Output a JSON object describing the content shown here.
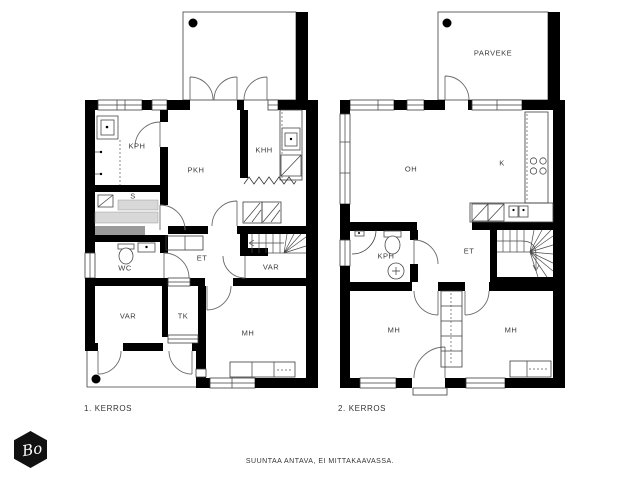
{
  "colors": {
    "wall": "#000000",
    "background": "#ffffff",
    "text": "#3a3a3a",
    "sauna_bench": "#d8d8d8",
    "sauna_bench_dark": "#9a9a9a",
    "logo_background": "#111111",
    "logo_text_color": "#ffffff"
  },
  "floor1": {
    "caption": "1. KERROS",
    "rooms": [
      {
        "label": "KPH"
      },
      {
        "label": "PKH"
      },
      {
        "label": "KHH"
      },
      {
        "label": "S"
      },
      {
        "label": "WC"
      },
      {
        "label": "ET"
      },
      {
        "label": "VAR"
      },
      {
        "label": "VAR"
      },
      {
        "label": "TK"
      },
      {
        "label": "MH"
      }
    ]
  },
  "floor2": {
    "caption": "2. KERROS",
    "rooms": [
      {
        "label": "PARVEKE"
      },
      {
        "label": "OH"
      },
      {
        "label": "K"
      },
      {
        "label": "KPH"
      },
      {
        "label": "ET"
      },
      {
        "label": "MH"
      },
      {
        "label": "MH"
      }
    ]
  },
  "footer": {
    "disclaimer": "SUUNTAA ANTAVA, EI MITTAKAAVASSA."
  },
  "logo": {
    "text": "Bo"
  }
}
